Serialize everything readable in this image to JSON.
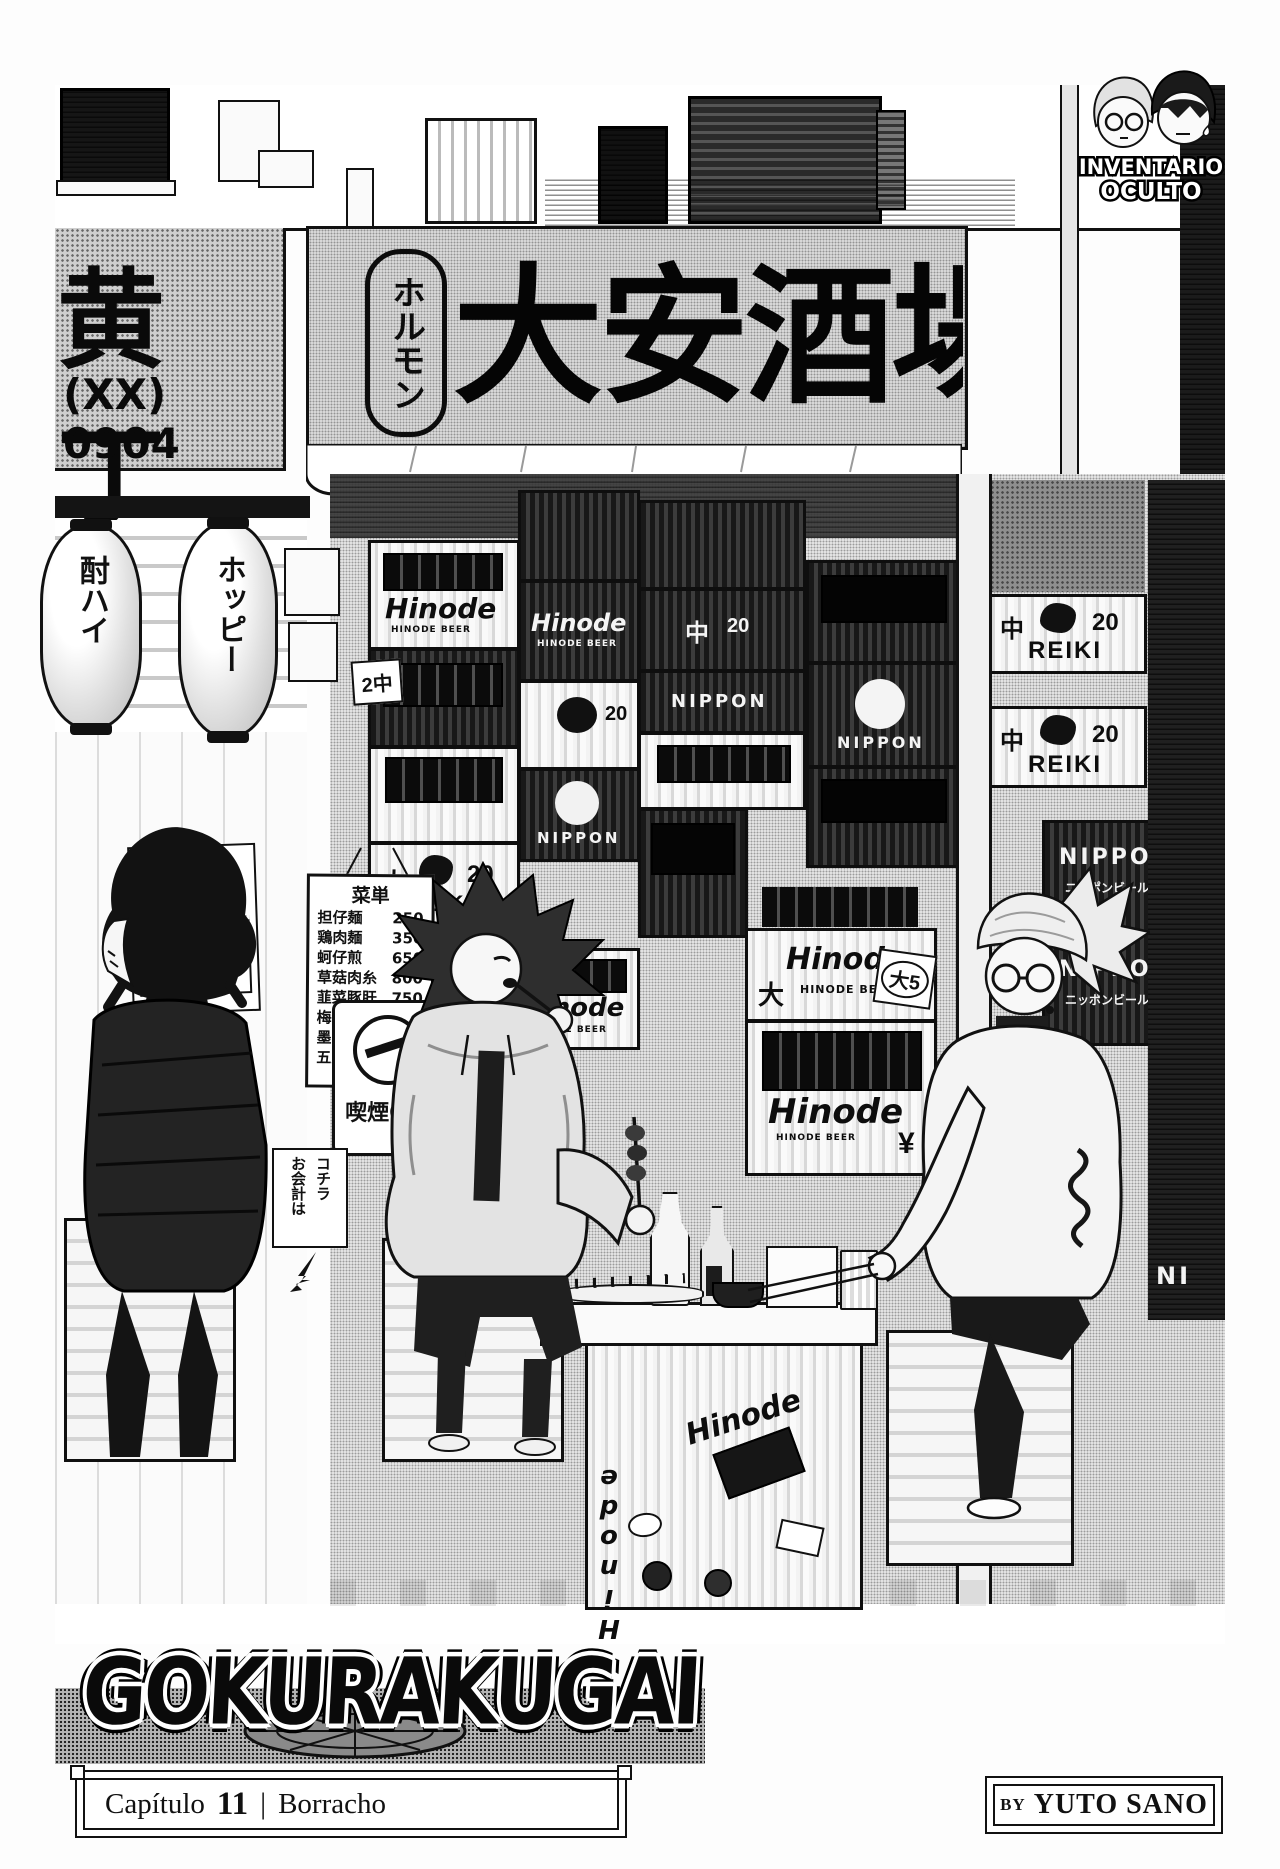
{
  "logo": {
    "line1": "INVENTARIO",
    "line2": "OCULTO"
  },
  "storefront": {
    "main_sign": {
      "oval_vertical": "ホルモン",
      "big_text": "大安酒場"
    },
    "side_sign": {
      "text": "黄丁",
      "phone": "(XX) 0904"
    },
    "lanterns": {
      "left": "酎ハイ",
      "right": "ホッピー"
    },
    "recruit_poster": {
      "line1": "アルバイト",
      "line2": "募集中!"
    },
    "menu": {
      "title": "菜単",
      "items": [
        {
          "name": "担仔麺",
          "price": "250"
        },
        {
          "name": "鶏肉麺",
          "price": "350"
        },
        {
          "name": "蚵仔煎",
          "price": "650"
        },
        {
          "name": "草菇肉糸",
          "price": "800"
        },
        {
          "name": "韮菜豚肝",
          "price": "750"
        },
        {
          "name": "梅漬草菇",
          "price": "600"
        },
        {
          "name": "墨肉煎蛋",
          "price": "850"
        },
        {
          "name": "五更腸旺",
          "price": "1000"
        }
      ]
    },
    "smoking_sign": "喫煙OK",
    "payment_sign": {
      "line1": "お会計は",
      "line2": "コチラ"
    }
  },
  "crates": {
    "hinode": "Hinode",
    "hinode_partial": "Hinod",
    "hinode_sub": "HINODE BEER",
    "nippon": "NIPPON",
    "nippon_sub": "ニッポンビール",
    "reiki": "REIKI",
    "size_m": "中",
    "size_l": "大",
    "count_20": "20",
    "tag_2m": "2中",
    "tag_l5": "大5",
    "yen": "¥",
    "partial_ni": "NI"
  },
  "title": {
    "text": "GOKURAKUGAI"
  },
  "footer": {
    "chapter_word": "Capítulo",
    "chapter_number": "11",
    "separator": "|",
    "chapter_name": "Borracho",
    "credit_by": "BY",
    "credit_name": "YUTO SANO"
  },
  "colors": {
    "ink": "#0d0d0d",
    "paper": "#fdfdfd"
  }
}
